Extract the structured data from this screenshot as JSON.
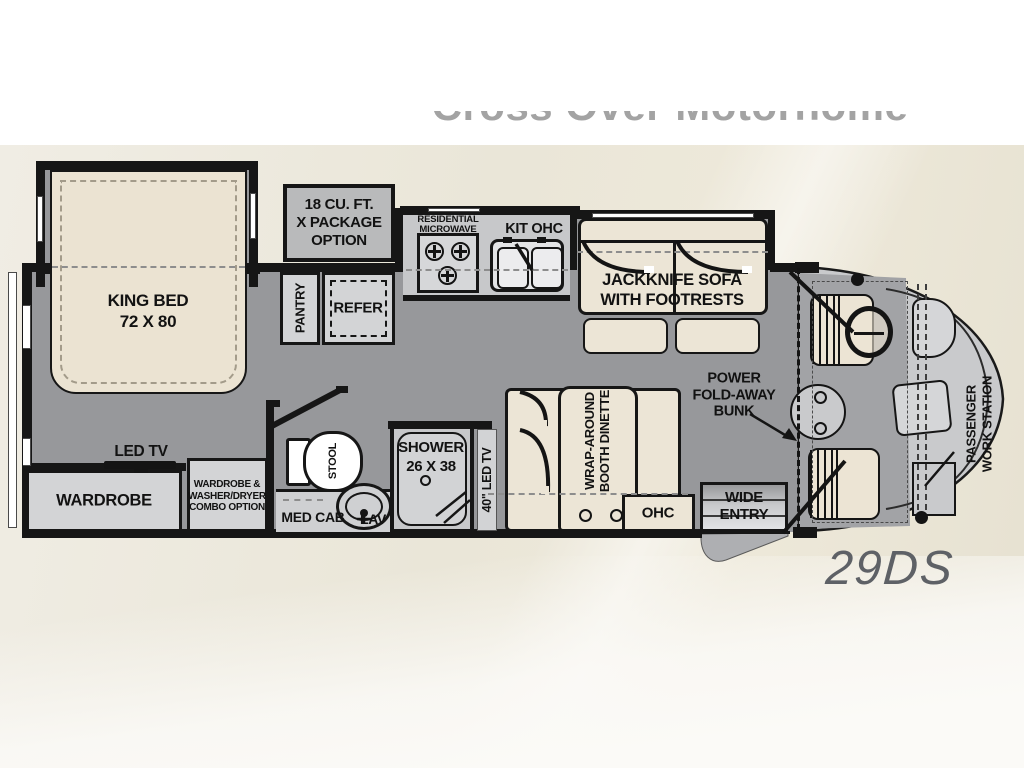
{
  "page": {
    "clipped_title": "Cross Over Motorhome",
    "model": "29DS"
  },
  "colors": {
    "wall": "#161616",
    "floor_gray": "#97989b",
    "front_cap_gray": "#c9cacc",
    "furniture_beige": "#ece4d4",
    "cabinet_gray": "#d3d4d6",
    "counter_gray": "#c7c8ca",
    "option_box_gray": "#b9babb",
    "background_cream": "#eae6d8",
    "title_gray": "#a3a3a3",
    "model_gray": "#5e6166"
  },
  "floorplan": {
    "bedroom": {
      "king_bed": [
        "KING BED",
        "72 X 80"
      ],
      "led_tv": "LED TV",
      "wardrobe": "WARDROBE",
      "wardrobe_combo": [
        "WARDROBE &",
        "WASHER/DRYER",
        "COMBO OPTION"
      ]
    },
    "options": {
      "x_package": [
        "18 CU. FT.",
        "X PACKAGE",
        "OPTION"
      ]
    },
    "kitchen": {
      "pantry": "PANTRY",
      "refer": "REFER",
      "microwave": [
        "RESIDENTIAL",
        "MICROWAVE"
      ],
      "kit_ohc": "KIT OHC"
    },
    "living": {
      "sofa": [
        "JACKKNIFE SOFA",
        "WITH FOOTRESTS"
      ],
      "dinette": [
        "WRAP-AROUND",
        "BOOTH DINETTE"
      ],
      "ohc": "OHC",
      "tv_40": "40\" LED TV"
    },
    "bath": {
      "stool": "STOOL",
      "shower": [
        "SHOWER",
        "26 X 38"
      ],
      "med_cab": "MED CAB",
      "lav": "LAV"
    },
    "front": {
      "bunk": [
        "POWER",
        "FOLD-AWAY",
        "BUNK"
      ],
      "wide_entry": [
        "WIDE",
        "ENTRY"
      ],
      "work_station": [
        "PASSENGER",
        "WORK STATION"
      ]
    }
  }
}
